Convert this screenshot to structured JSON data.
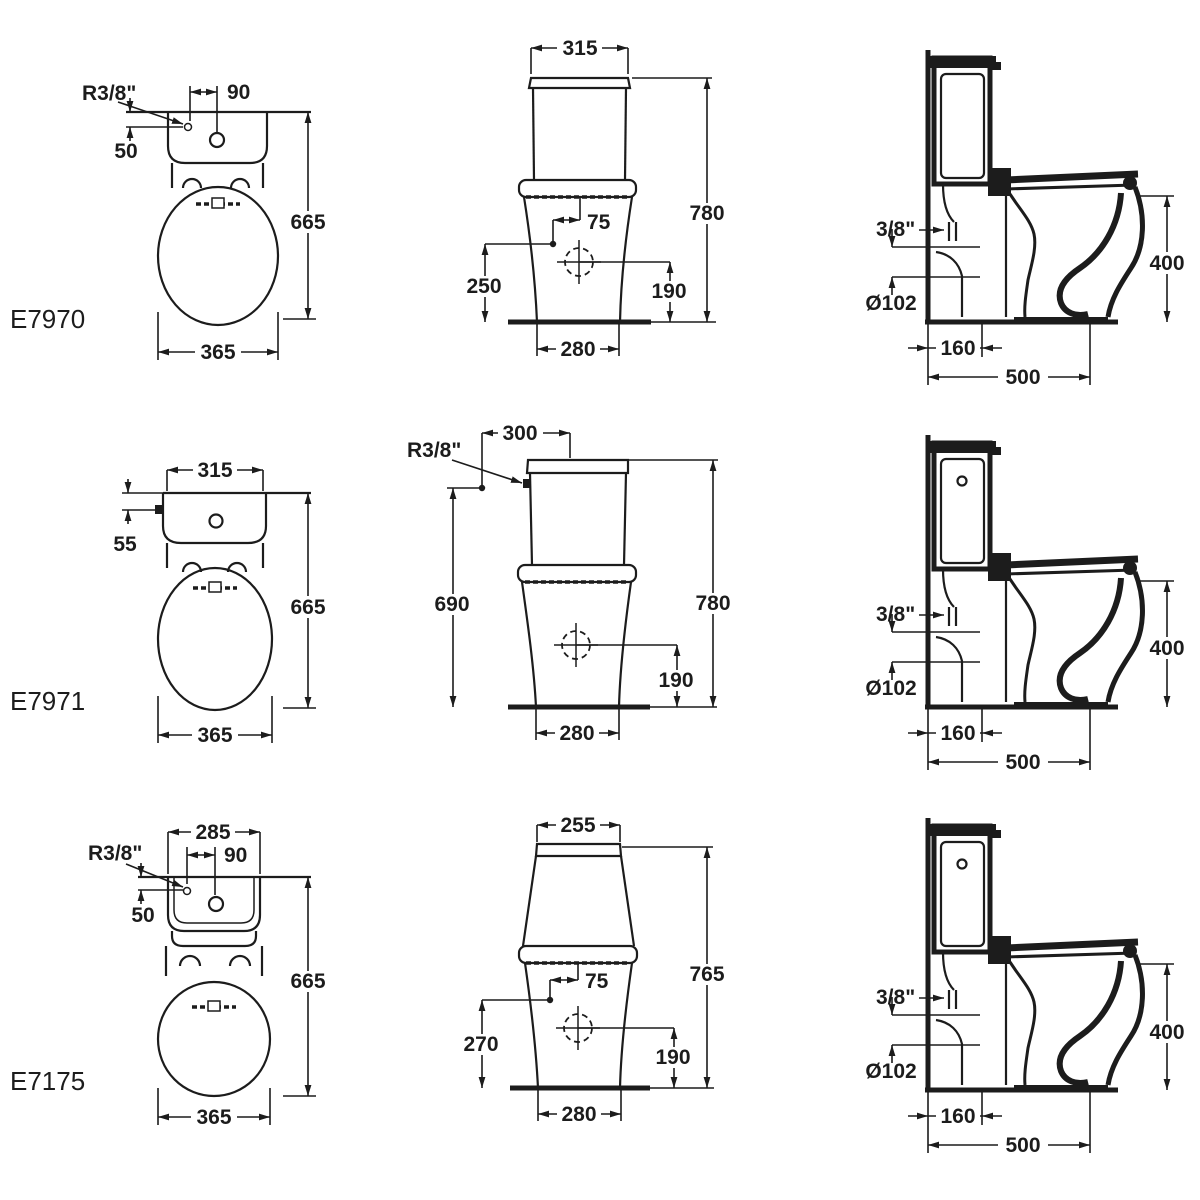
{
  "page": {
    "background": "#ffffff",
    "ink": "#1c1c1c"
  },
  "models": [
    {
      "id": "E7970",
      "front": {
        "inlet_radius": "R3/8\"",
        "offset_90": "90",
        "inlet_drop": "50",
        "height": "665",
        "width": "365"
      },
      "elevation": {
        "cistern_width": "315",
        "total_height": "780",
        "supply_offset": "75",
        "supply_height": "250",
        "outlet_height": "190",
        "base_width": "280"
      },
      "side": {
        "inlet": "3/8\"",
        "outlet_diameter": "Ø102",
        "bowl_height": "400",
        "outlet_offset": "160",
        "depth": "500"
      }
    },
    {
      "id": "E7971",
      "front": {
        "cistern_width": "315",
        "inlet_drop": "55",
        "height": "665",
        "width": "365"
      },
      "elevation": {
        "supply_offset": "300",
        "inlet_radius": "R3/8\"",
        "supply_height": "690",
        "total_height": "780",
        "outlet_height": "190",
        "base_width": "280"
      },
      "side": {
        "inlet": "3/8\"",
        "outlet_diameter": "Ø102",
        "bowl_height": "400",
        "outlet_offset": "160",
        "depth": "500"
      }
    },
    {
      "id": "E7175",
      "front": {
        "cistern_width": "285",
        "offset_90": "90",
        "inlet_radius": "R3/8\"",
        "inlet_drop": "50",
        "height": "665",
        "width": "365"
      },
      "elevation": {
        "cistern_width": "255",
        "total_height": "765",
        "supply_offset": "75",
        "supply_height": "270",
        "outlet_height": "190",
        "base_width": "280"
      },
      "side": {
        "inlet": "3/8\"",
        "outlet_diameter": "Ø102",
        "bowl_height": "400",
        "outlet_offset": "160",
        "depth": "500"
      }
    }
  ]
}
